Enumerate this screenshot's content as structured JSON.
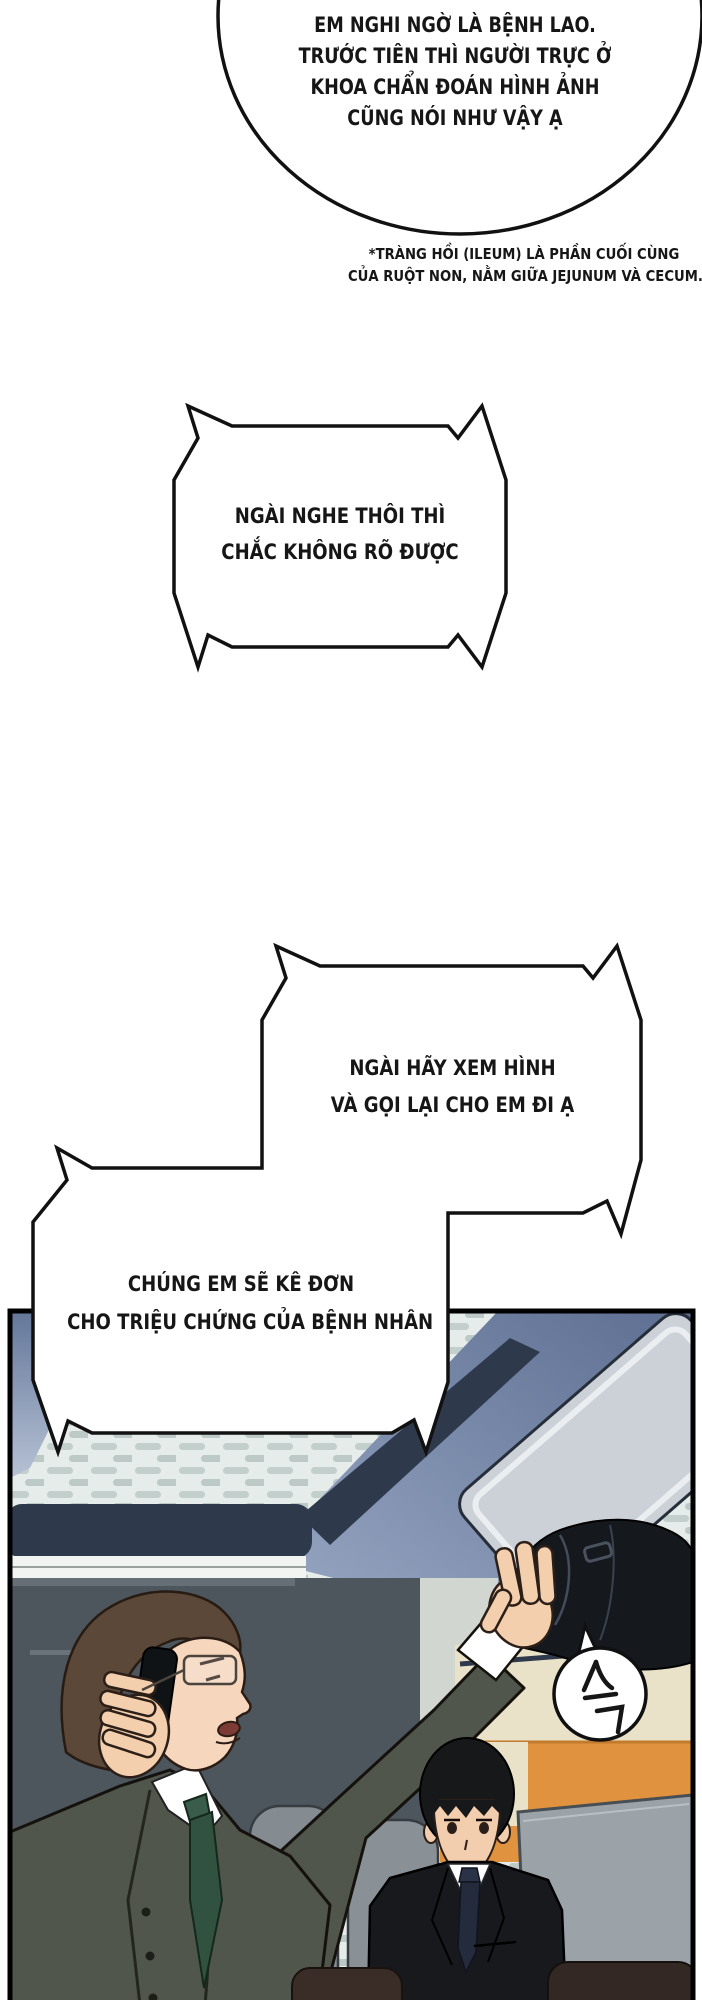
{
  "page": {
    "kind": "manhwa page (Vietnamese translation)",
    "background": "#ffffff",
    "ink": "#111111"
  },
  "bubbles": {
    "bubble1": {
      "shape": "ellipse",
      "lines": [
        "EM NGHI NGỜ LÀ BỆNH LAO.",
        "TRƯỚC TIÊN THÌ NGƯỜI TRỰC Ở",
        "KHOA CHẨN ĐOÁN HÌNH ẢNH",
        "CŨNG NÓI NHƯ VẬY Ạ"
      ]
    },
    "bubble2": {
      "shape": "jagged-rect",
      "lines": [
        "NGÀI NGHE THÔI THÌ",
        "CHẮC KHÔNG RÕ ĐƯỢC"
      ]
    },
    "bubble3": {
      "shape": "jagged-rect",
      "lines": [
        "NGÀI HÃY XEM HÌNH",
        "VÀ GỌI LẠI CHO EM ĐI Ạ"
      ]
    },
    "bubble4": {
      "shape": "jagged-rect",
      "lines": [
        "CHÚNG EM SẼ KÊ ĐƠN",
        "CHO TRIỆU CHỨNG CỦA BỆNH NHÂN"
      ]
    }
  },
  "footnote": {
    "lines": [
      "*TRÀNG HỒI (ILEUM) LÀ PHẦN CUỐI CÙNG",
      "CỦA RUỘT NON, NẰM GIỮA JEJUNUM VÀ CECUM."
    ]
  },
  "sfx": {
    "text": "슥"
  },
  "panel_colors": {
    "border": "#000000",
    "ceiling": "#e6ece9",
    "ceiling_dash": "#bcc9c7",
    "rack_slate_light": "#9aa9c4",
    "rack_slate_dark": "#5d6e92",
    "rack_bar_navy": "#2e3a4c",
    "door_gray": "#ccd1d8",
    "window_gray": "#4d555d",
    "wall_beige": "#e9e2c8",
    "seat_orange": "#e0923e",
    "screen_gray": "#9ba2a8",
    "headrest_gray": "#858c91",
    "suit_olive": "#51564c",
    "suit_black": "#17191d",
    "skin": "#f4cfae",
    "hair_brown": "#5b4839",
    "hair_black": "#17181a",
    "tie_green": "#315141",
    "tie_navy": "#232b3d",
    "coat_black": "#15181c",
    "seat_top_brown": "#3a2d28"
  }
}
